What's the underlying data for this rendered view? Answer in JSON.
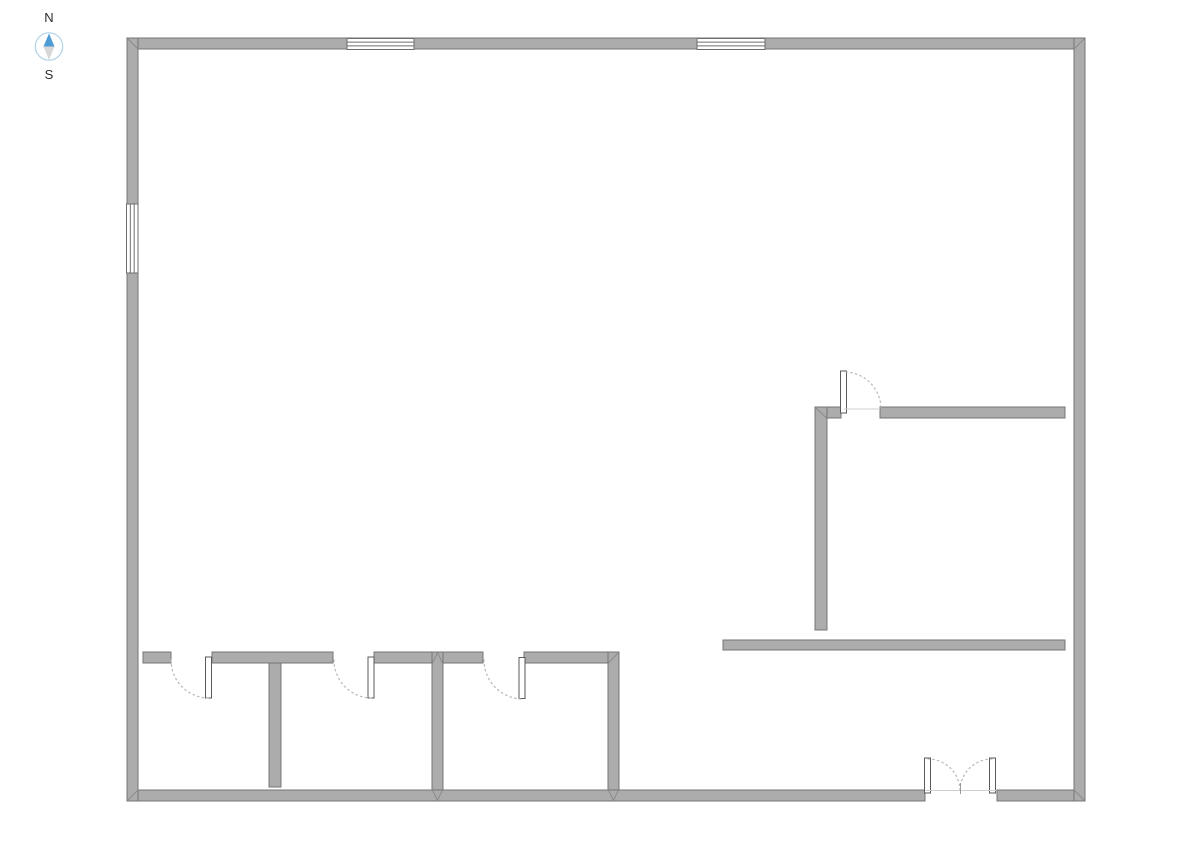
{
  "app": {
    "description": "floor-plan-editor-canvas"
  },
  "compass": {
    "north_label": "N",
    "south_label": "S",
    "cx": 49,
    "cy": 46.5,
    "r": 13.7,
    "ring_color": "#AFD2E8",
    "north_needle_color": "#4E9CD6",
    "south_needle_color": "#D8D8D8",
    "label_color": "#2B2B2B"
  },
  "plan": {
    "colors": {
      "background": "#FFFFFF",
      "wall_fill": "#ACACAC",
      "wall_stroke": "#757575",
      "miter_line": "#8A8A8A",
      "window_fill": "#FFFFFF",
      "window_stroke": "#6E6E6E",
      "door_leaf_fill": "#FFFFFF",
      "door_leaf_stroke": "#5A5A5A",
      "door_arc": "#B5B5B5",
      "opening_line": "#CFCFCF",
      "tick": "#9B9B9B"
    },
    "walls": [
      {
        "name": "outer-wall-top",
        "x": 127,
        "y": 38,
        "w": 958,
        "h": 11
      },
      {
        "name": "outer-wall-bottom-left-of-door",
        "x": 127,
        "y": 790,
        "w": 798,
        "h": 11
      },
      {
        "name": "outer-wall-bottom-right-of-door",
        "x": 997,
        "y": 790,
        "w": 88,
        "h": 11
      },
      {
        "name": "outer-wall-left",
        "x": 127,
        "y": 38,
        "w": 11,
        "h": 763
      },
      {
        "name": "outer-wall-right",
        "x": 1074,
        "y": 38,
        "w": 11,
        "h": 763
      },
      {
        "name": "partition-wall-stub",
        "x": 143,
        "y": 652,
        "w": 28,
        "h": 11
      },
      {
        "name": "partition-wall-a",
        "x": 212,
        "y": 652,
        "w": 121,
        "h": 11
      },
      {
        "name": "partition-wall-b",
        "x": 374,
        "y": 652,
        "w": 109,
        "h": 11
      },
      {
        "name": "partition-wall-c",
        "x": 524,
        "y": 652,
        "w": 95,
        "h": 11
      },
      {
        "name": "room-divider-wall-1",
        "x": 269,
        "y": 663,
        "w": 12,
        "h": 124
      },
      {
        "name": "room-divider-wall-2",
        "x": 432,
        "y": 652,
        "w": 11,
        "h": 138
      },
      {
        "name": "room-divider-wall-3",
        "x": 608,
        "y": 652,
        "w": 11,
        "h": 138
      },
      {
        "name": "right-room-wall-corner-h",
        "x": 815,
        "y": 407,
        "w": 26,
        "h": 11
      },
      {
        "name": "right-room-wall-top",
        "x": 880,
        "y": 407,
        "w": 185,
        "h": 11
      },
      {
        "name": "right-room-wall-vertical",
        "x": 815,
        "y": 407,
        "w": 12,
        "h": 223
      },
      {
        "name": "right-room-wall-lower",
        "x": 723,
        "y": 640,
        "w": 342,
        "h": 10
      }
    ],
    "miters": [
      {
        "x1": 127.5,
        "y1": 38.5,
        "x2": 138,
        "y2": 49
      },
      {
        "x1": 1084.5,
        "y1": 38.5,
        "x2": 1074,
        "y2": 49
      },
      {
        "x1": 127.5,
        "y1": 800.5,
        "x2": 138,
        "y2": 790
      },
      {
        "x1": 1084.5,
        "y1": 800.5,
        "x2": 1074,
        "y2": 790
      },
      {
        "x1": 618.5,
        "y1": 652.5,
        "x2": 608.5,
        "y2": 663
      },
      {
        "x1": 608.5,
        "y1": 790,
        "x2": 613.5,
        "y2": 800.5
      },
      {
        "x1": 618.5,
        "y1": 790,
        "x2": 613.5,
        "y2": 800.5
      },
      {
        "x1": 432.5,
        "y1": 663,
        "x2": 437.5,
        "y2": 652.5
      },
      {
        "x1": 442.5,
        "y1": 663,
        "x2": 437.5,
        "y2": 652.5
      },
      {
        "x1": 432.5,
        "y1": 790,
        "x2": 437.5,
        "y2": 800.5
      },
      {
        "x1": 442.5,
        "y1": 790,
        "x2": 437.5,
        "y2": 800.5
      },
      {
        "x1": 815.5,
        "y1": 407.5,
        "x2": 826.5,
        "y2": 418
      }
    ],
    "windows": [
      {
        "name": "window-top-1",
        "x": 347,
        "y": 38.5,
        "w": 67,
        "h": 11,
        "dir": "h",
        "apron": 3
      },
      {
        "name": "window-top-2",
        "x": 697,
        "y": 38.5,
        "w": 68,
        "h": 11,
        "dir": "h",
        "apron": 3
      },
      {
        "name": "window-left",
        "x": 126.5,
        "y": 204,
        "w": 11.5,
        "h": 69,
        "dir": "v",
        "apron": 2
      }
    ],
    "door_leaves": [
      {
        "name": "door-leaf-1",
        "x": 205.5,
        "y": 657,
        "w": 6,
        "h": 41
      },
      {
        "name": "door-leaf-2",
        "x": 368,
        "y": 657,
        "w": 6,
        "h": 41
      },
      {
        "name": "door-leaf-3",
        "x": 519,
        "y": 657.5,
        "w": 6,
        "h": 41
      },
      {
        "name": "door-leaf-right-room",
        "x": 840.5,
        "y": 371,
        "w": 6,
        "h": 42
      },
      {
        "name": "double-door-leaf-left",
        "x": 924.5,
        "y": 758,
        "w": 6,
        "h": 35
      },
      {
        "name": "double-door-leaf-right",
        "x": 989.5,
        "y": 758,
        "w": 6,
        "h": 35
      }
    ],
    "door_arcs": [
      {
        "name": "door-swing-arc-1",
        "d": "M 171 660 A 38 38 0 0 0 208 698"
      },
      {
        "name": "door-swing-arc-2",
        "d": "M 334 660 A 38 38 0 0 0 371 698"
      },
      {
        "name": "door-swing-arc-3",
        "d": "M 484 660 A 39 39 0 0 0 522 699"
      },
      {
        "name": "door-swing-arc-right-room",
        "d": "M 846 372 A 37 37 0 0 1 881 409"
      },
      {
        "name": "double-door-swing-arc-left",
        "d": "M 928 759 A 32 32 0 0 1 960 790"
      },
      {
        "name": "double-door-swing-arc-right",
        "d": "M 992 759 A 32 32 0 0 0 960 790"
      }
    ],
    "lines": [
      {
        "name": "right-door-opening-line",
        "x1": 844,
        "y1": 409,
        "x2": 880,
        "y2": 409,
        "color": "opening_line"
      },
      {
        "name": "double-door-threshold-line",
        "x1": 925.5,
        "y1": 790.5,
        "x2": 996.5,
        "y2": 790.5,
        "color": "opening_line"
      },
      {
        "name": "double-door-center-tick",
        "x1": 960.5,
        "y1": 783,
        "x2": 960.5,
        "y2": 794,
        "color": "tick"
      }
    ]
  }
}
